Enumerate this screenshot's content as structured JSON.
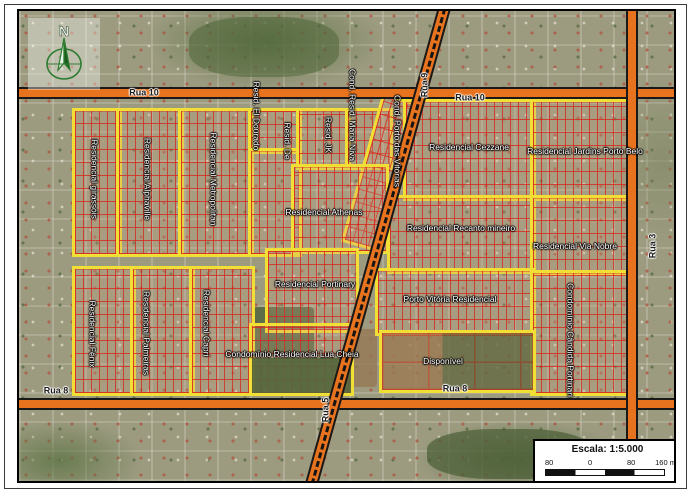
{
  "map": {
    "north_label": "N",
    "road_labels": {
      "rua10_left": "Rua 10",
      "rua10_right": "Rua 10",
      "rua8_left": "Rua 8",
      "rua8_right": "Rua 8",
      "rua9": "Rua 9",
      "rua5": "Rua 5",
      "rua3": "Rua 3"
    },
    "area_labels": {
      "girassois": "Residencial girassóis",
      "alphaville": "Residencial Alphaville",
      "metropolitan": "Residencial Metropolitan",
      "eldourado": "Resid. El Dourado",
      "resid_de": "Resid. De",
      "jk": "Resid. JK",
      "maria_niva": "Cond. Resid. Maria Niva",
      "porto_das_vitorias": "Cond. Porto das Vitórias",
      "cezzane": "Residencial Cezzane",
      "jardins_porto_belo": "Residencial Jardins Porto Belo",
      "athenas": "Residencial Athenas",
      "recanto_mineiro": "Residencial Recanto mineiro",
      "via_nobre": "Residencial Via Nobre",
      "portinary": "Residencial Portinary",
      "porto_vitoria": "Porto Vitória Residencial",
      "candida_portinari": "Condomínio Cândida Portinari",
      "lua_cheia": "Condomínio Residencial Lua Cheia",
      "disponivel": "Disponível",
      "fenix": "Residencial Fênix",
      "palmeiras": "Residencial Palmeiras",
      "capri": "Residencial Capri"
    }
  },
  "scale": {
    "label": "Escala:",
    "ratio": "1:5.000",
    "ticks": [
      "80",
      "0",
      "80",
      "160 m"
    ]
  },
  "colors": {
    "road_orange": "#e8731e",
    "boundary_yellow": "#f2df35",
    "lot_red": "#d62a1c",
    "compass_green": "#2e7d32"
  }
}
